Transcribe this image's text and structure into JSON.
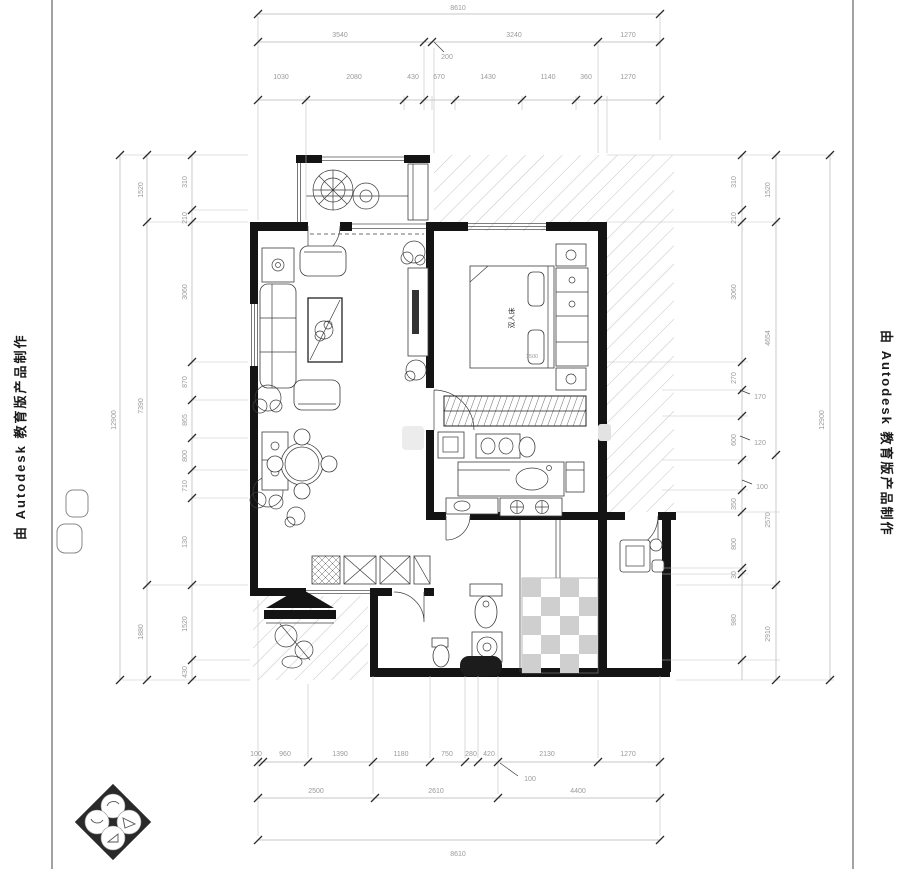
{
  "branding": {
    "edu_watermark": "由 Autodesk 教育版产品制作"
  },
  "dims": {
    "top": {
      "total": "8610",
      "row2": [
        "3540",
        "3240",
        "1270"
      ],
      "leader": "200",
      "row3": [
        "1030",
        "2080",
        "430",
        "670",
        "1430",
        "1140",
        "360",
        "1270"
      ]
    },
    "bottom": {
      "row1": [
        "100",
        "960",
        "1390",
        "1180",
        "750",
        "280",
        "420",
        "2130",
        "1270"
      ],
      "leader": "100",
      "row2": [
        "2500",
        "2610",
        "4400"
      ],
      "total": "8610"
    },
    "left": {
      "total": "12900",
      "middle": [
        "1520",
        "7390",
        "1880"
      ],
      "inner": [
        "310",
        "210",
        "3060",
        "870",
        "865",
        "800",
        "710",
        "130",
        "1520",
        "430"
      ]
    },
    "right": {
      "total": "12900",
      "middle": [
        "1520",
        "4654",
        "2570",
        "2910"
      ],
      "inner": [
        "310",
        "210",
        "3060",
        "270",
        "600",
        "350",
        "800",
        "30",
        "980"
      ],
      "leaders": [
        "170",
        "120",
        "100"
      ]
    }
  },
  "plan": {
    "bed_label": "双人床",
    "bed_dim": "1500"
  },
  "colors": {
    "wall": "#141414",
    "dim_text": "#9a9a9a",
    "hatch": "#999999",
    "paper": "#ffffff"
  }
}
